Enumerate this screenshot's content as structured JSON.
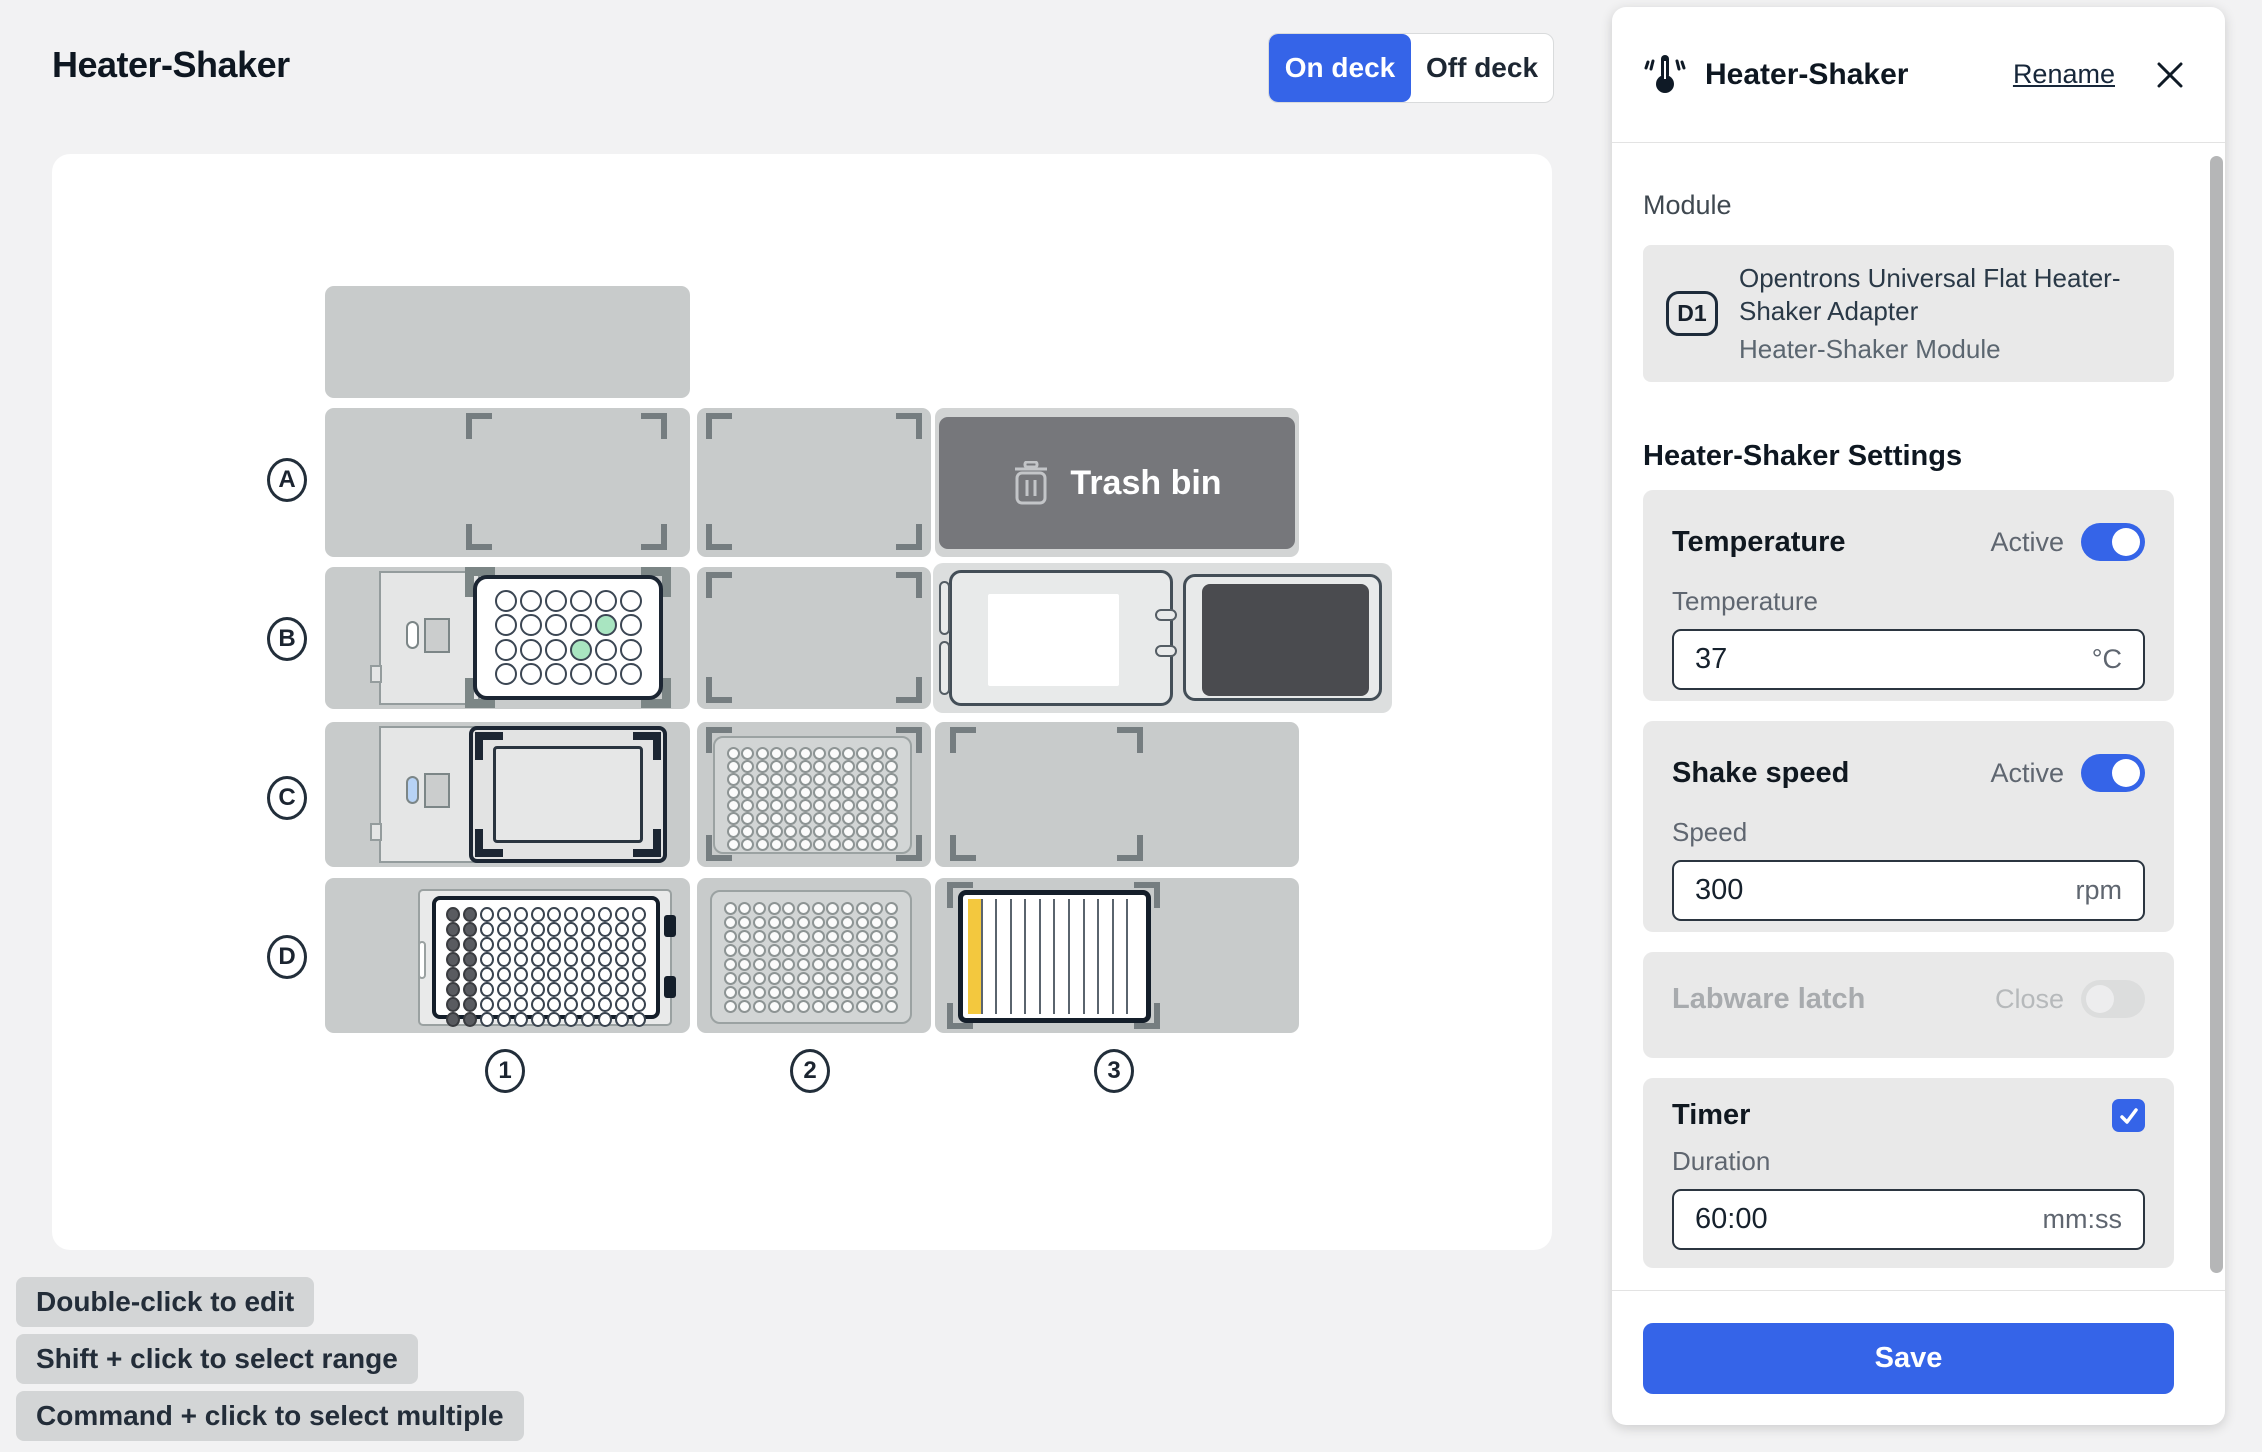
{
  "page": {
    "title": "Heater-Shaker"
  },
  "view_toggle": {
    "on_label": "On deck",
    "off_label": "Off deck"
  },
  "colors": {
    "accent": "#3564e8",
    "slot": "#c8cbcb",
    "bracket": "#757d80",
    "trash": "#76777b",
    "well-green": "#a9e5c1",
    "resv-yellow": "#f3c83e"
  },
  "deck": {
    "row_labels": [
      "A",
      "B",
      "C",
      "D"
    ],
    "column_labels": [
      "1",
      "2",
      "3"
    ],
    "trash": {
      "label": "Trash bin",
      "icon": "trash-icon"
    },
    "plates": {
      "b1_wellplate24": {
        "rows": 4,
        "cols": 6,
        "green": [
          [
            1,
            4
          ],
          [
            2,
            3
          ]
        ]
      },
      "c2_wellplate96": {
        "rows": 8,
        "cols": 12
      },
      "d1_wellplate96": {
        "rows": 8,
        "cols": 12,
        "filled_cols": 2
      },
      "d2_wellplate96": {
        "rows": 8,
        "cols": 12
      },
      "d3_reservoir": {
        "channels": 12,
        "filled": [
          0
        ]
      }
    }
  },
  "hints": [
    "Double-click to edit",
    "Shift + click to select range",
    "Command + click to select multiple"
  ],
  "panel": {
    "icon": "thermometer-shake-icon",
    "title": "Heater-Shaker",
    "rename_label": "Rename",
    "close_icon": "close-icon",
    "module_section_label": "Module",
    "module": {
      "slot": "D1",
      "adapter_name": "Opentrons Universal Flat Heater-Shaker Adapter",
      "module_name": "Heater-Shaker Module"
    },
    "settings_heading": "Heater-Shaker Settings",
    "temperature": {
      "label": "Temperature",
      "state_label": "Active",
      "state": "on",
      "field_label": "Temperature",
      "value": "37",
      "unit": "°C"
    },
    "shake": {
      "label": "Shake speed",
      "state_label": "Active",
      "state": "on",
      "field_label": "Speed",
      "value": "300",
      "unit": "rpm"
    },
    "latch": {
      "label": "Labware latch",
      "state_label": "Close",
      "state": "off-disabled"
    },
    "timer": {
      "label": "Timer",
      "checked": true,
      "field_label": "Duration",
      "value": "60:00",
      "unit": "mm:ss"
    },
    "save_label": "Save"
  }
}
